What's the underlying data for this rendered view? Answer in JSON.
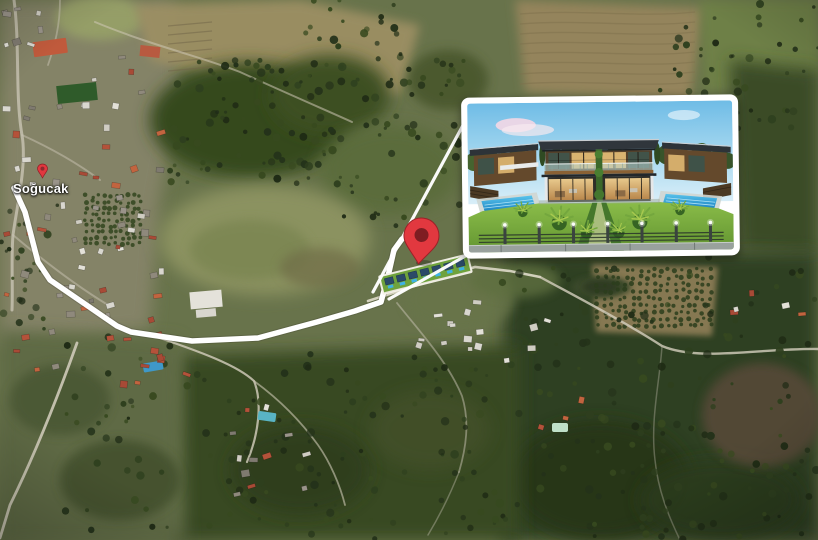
{
  "map": {
    "place_label": "Soğucak"
  },
  "colors": {
    "route": "#ffffff",
    "frame": "#ffffff",
    "pin": "#e2383f",
    "pin_hole": "#7e1d22",
    "pool": "#2f9fd6",
    "lawn": "#76a838",
    "sky": "#7ec3e8"
  }
}
